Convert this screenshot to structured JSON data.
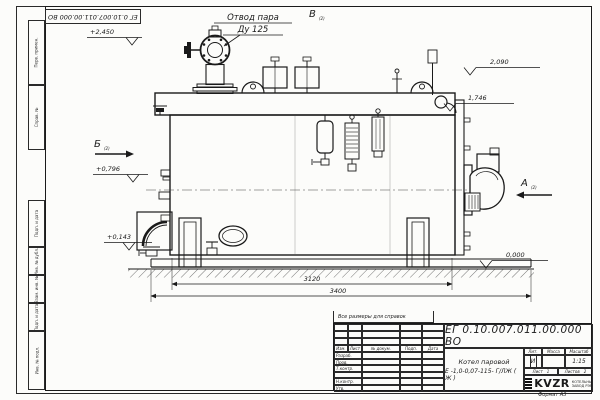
{
  "frame": {
    "top_stamp": "ЕГ 0.10.007.011.00.000  ВО",
    "side_labels": [
      "Перв. примен.",
      "Справ. №",
      "Подп. и дата",
      "Инв. № дубл.",
      "Взам. инв. №",
      "Подп. и дата",
      "Инв. № подл."
    ],
    "format_note": "Формат А3"
  },
  "drawing": {
    "callout": {
      "line1": "Отвод пара",
      "line2": "Ду 125"
    },
    "view_markers": {
      "top": "В",
      "left": "Б",
      "right": "А",
      "sub": "(2)"
    },
    "elevations": {
      "valve_top": "+2,450",
      "drum_top": "2,090",
      "shell_top": "1,746",
      "burner_axis": "+0,796",
      "base": "+0,143",
      "ground": "0,000"
    },
    "dimensions": {
      "shell_length": "3120",
      "overall_length": "3400"
    }
  },
  "title_block": {
    "reference_note": "Все размеры для справок",
    "doc_number": "ЕГ 0.10.007.011.00.000  ВО",
    "product_name_line1": "Котел паровой",
    "product_name_line2": "Е -1,0-0,07-115- Г/ЛЖ ( Ж )",
    "columns": {
      "izm": "Изм.",
      "list": "Лист",
      "doc": "№ докум.",
      "podp": "Подп.",
      "data": "Дата"
    },
    "rows": [
      "Разраб.",
      "Пров.",
      "Т.контр.",
      "",
      "Н.контр.",
      "Утв."
    ],
    "lit_header": "Лит.",
    "lit_value": "И",
    "mass_header": "Масса",
    "mass_value": "",
    "scale_header": "Масштаб",
    "scale_value": "1:15",
    "sheet_label": "Лист",
    "sheet_value": "1",
    "sheets_label": "Листов",
    "sheets_value": "2",
    "logo_text": "KVZR",
    "logo_caption_line1": "КОТЕЛЬНЫЙ",
    "logo_caption_line2": "ЗАВОД РЭР"
  }
}
